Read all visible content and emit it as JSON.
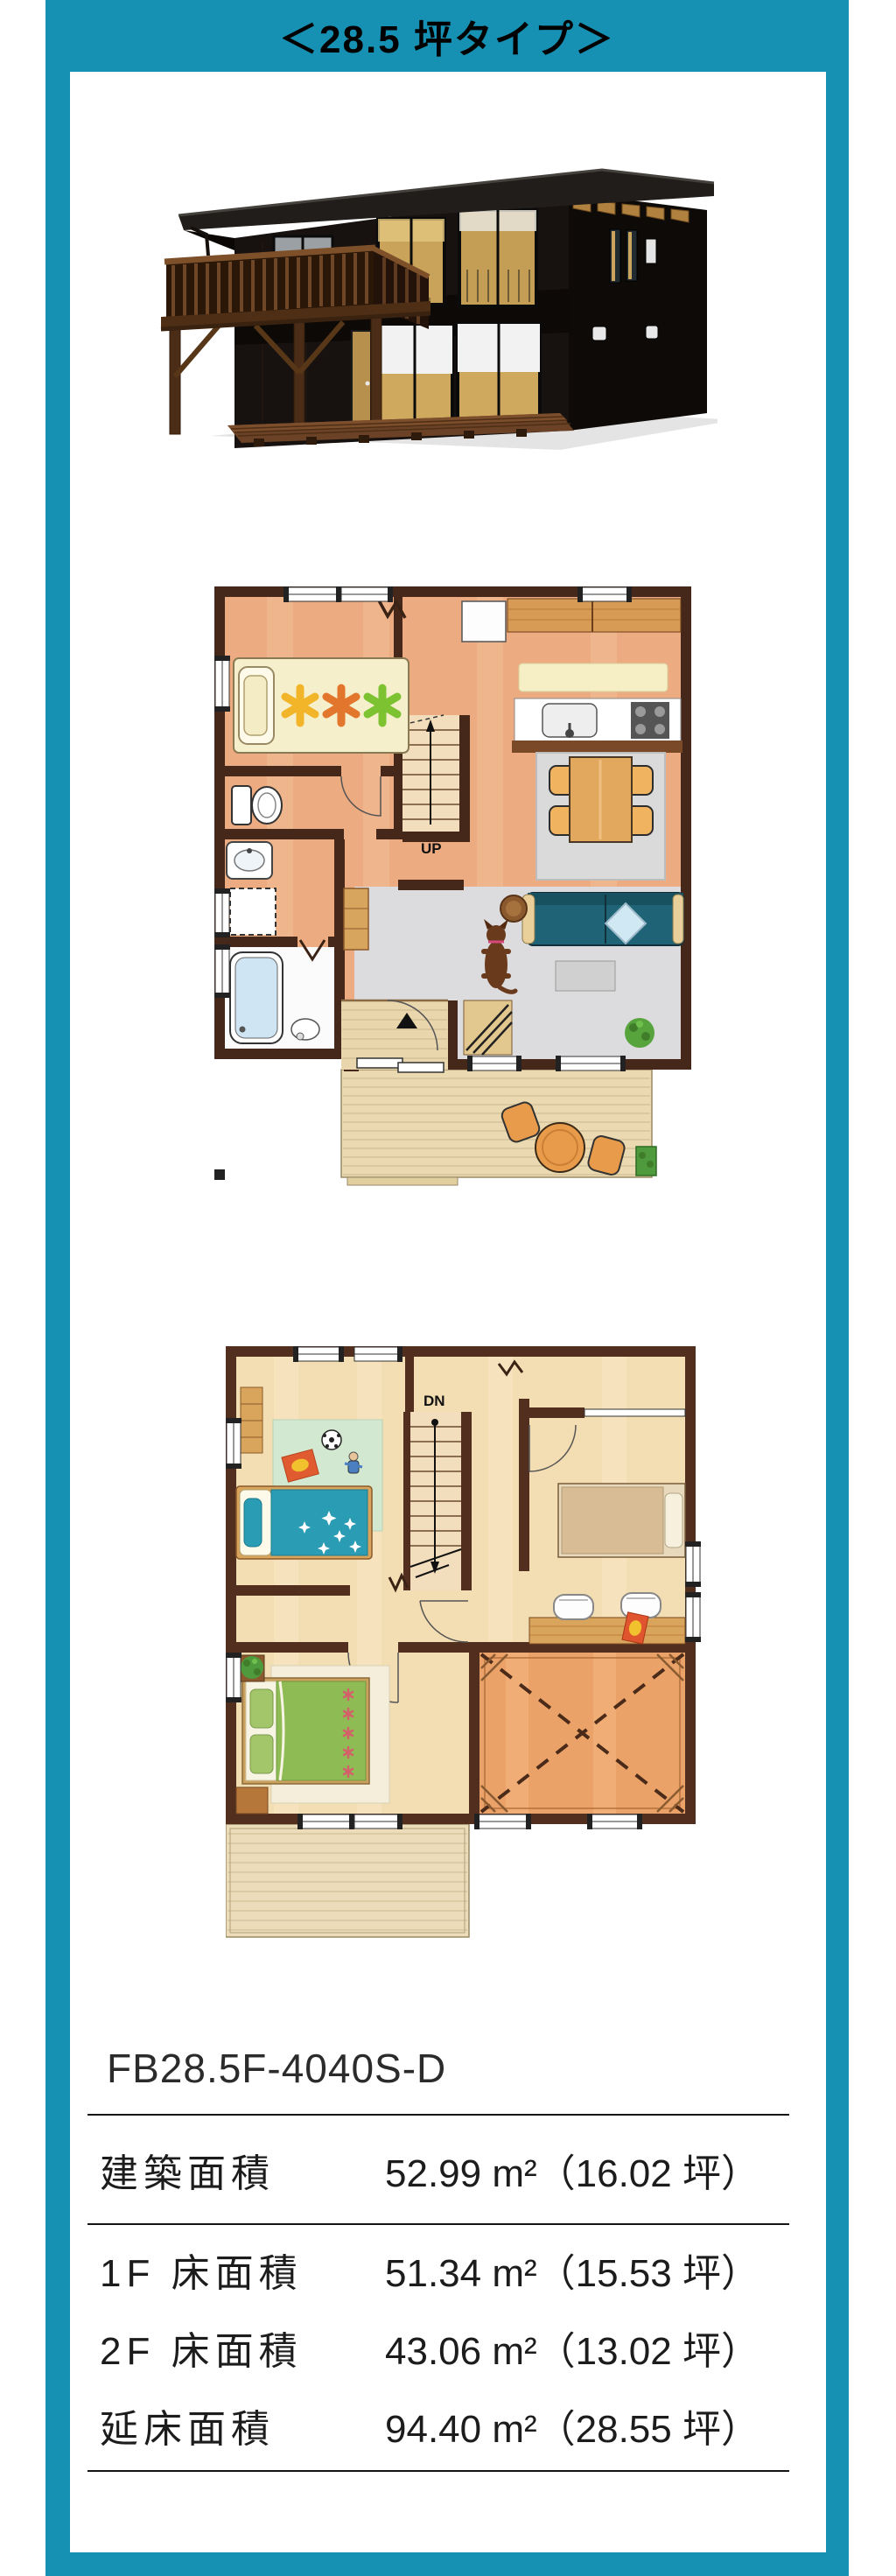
{
  "page": {
    "background": "#ffffff",
    "accent_color": "#1791b3"
  },
  "header": {
    "title": "＜28.5 坪タイプ＞",
    "text_color": "#000000"
  },
  "house_render": {
    "name": "exterior-3d-render"
  },
  "floor_plans": {
    "f1": {
      "stair_label": "UP"
    },
    "f2": {
      "stair_label": "DN"
    }
  },
  "model": {
    "code": "FB28.5F-4040S-D"
  },
  "spec_table": {
    "rows": [
      {
        "label": "建築面積",
        "value": "52.99 m²（16.02 坪）"
      },
      {
        "label": "1F 床面積",
        "value": "51.34 m²（15.53 坪）"
      },
      {
        "label": "2F 床面積",
        "value": "43.06 m²（13.02 坪）"
      },
      {
        "label": "延床面積",
        "value": "94.40 m²（28.55 坪）"
      }
    ]
  }
}
